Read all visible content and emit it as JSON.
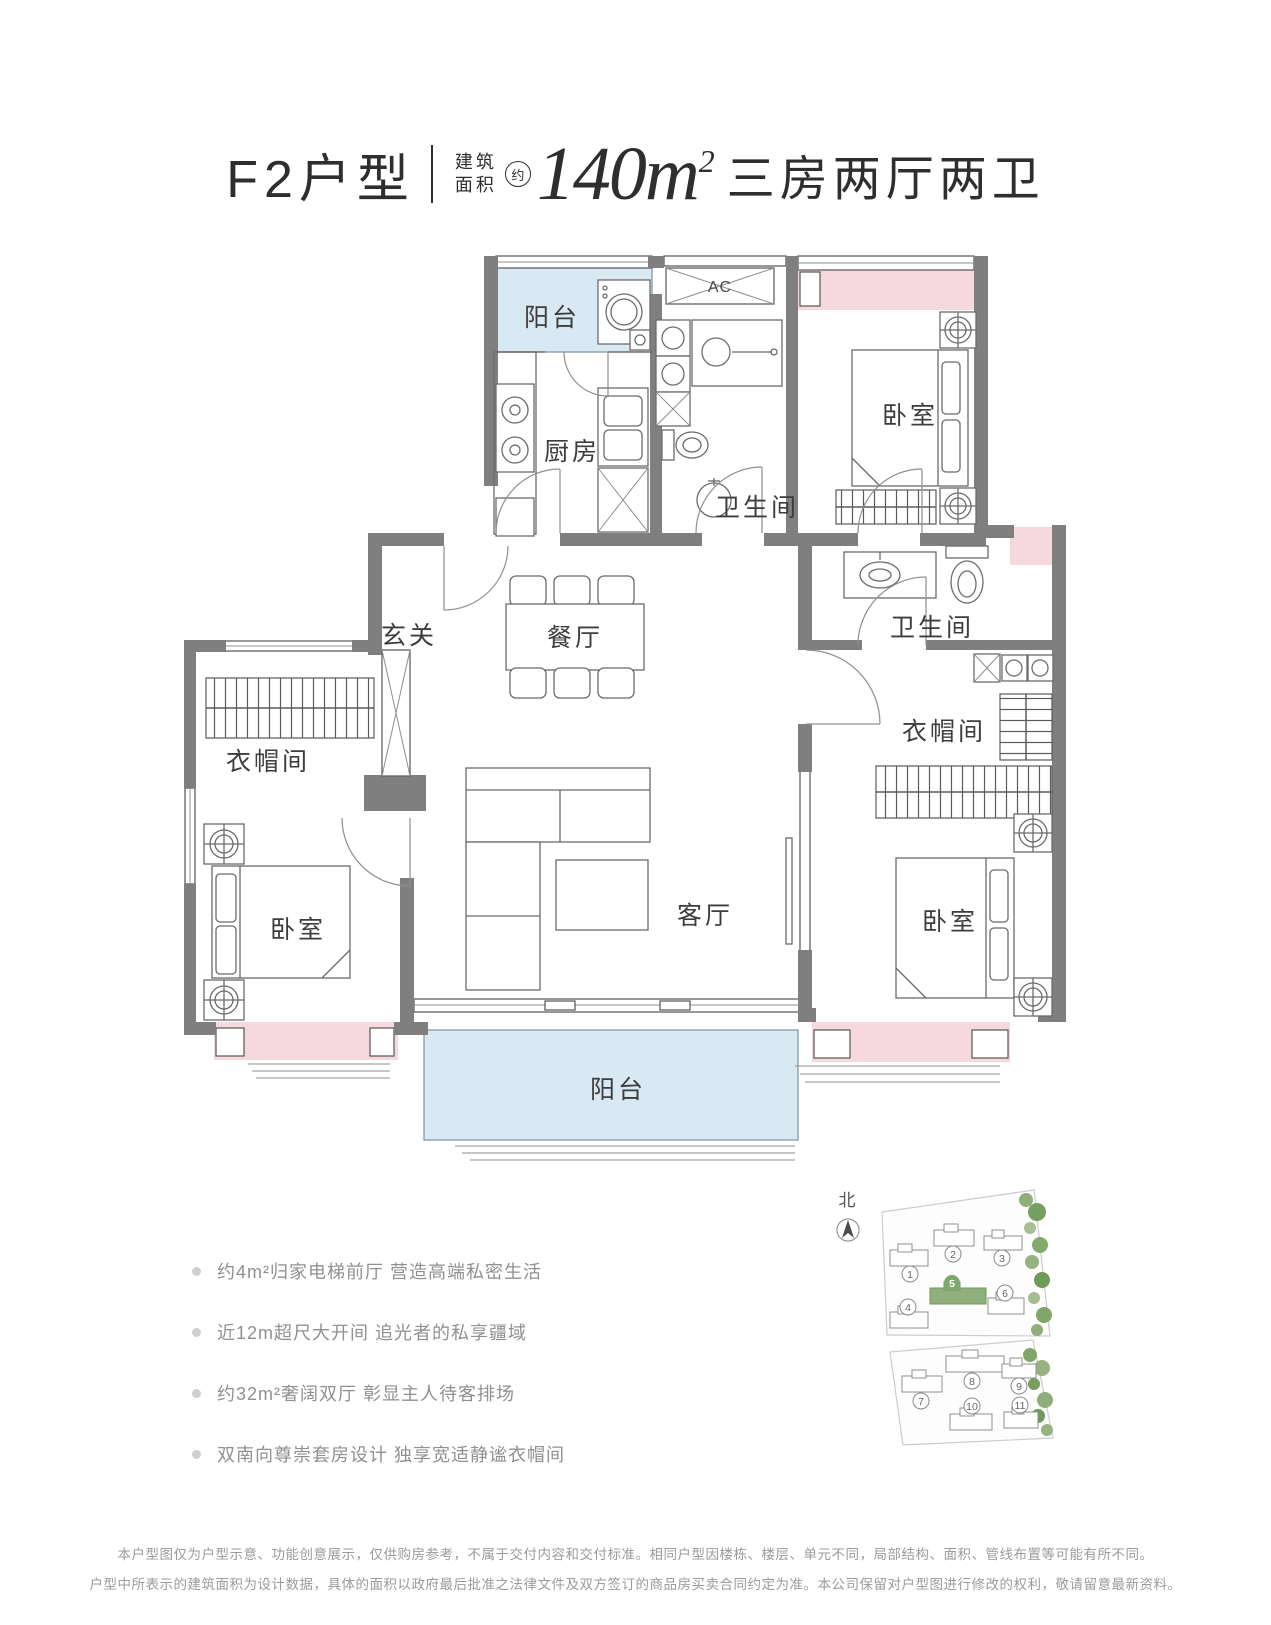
{
  "header": {
    "unit_name": "F2户型",
    "area_label_line1": "建筑",
    "area_label_line2": "面积",
    "approx_badge": "约",
    "area_value": "140m",
    "area_sup": "2",
    "layout_desc": "三房两厅两卫"
  },
  "floorplan": {
    "labels": {
      "balcony_top": "阳台",
      "kitchen": "厨房",
      "ac_unit": "AC",
      "bath_top": "卫生间",
      "bedroom_top": "卧室",
      "foyer": "玄关",
      "dining": "餐厅",
      "bath_right": "卫生间",
      "cloakroom_right": "衣帽间",
      "cloakroom_left": "衣帽间",
      "bedroom_left": "卧室",
      "living": "客厅",
      "bedroom_right": "卧室",
      "balcony_bottom": "阳台"
    },
    "colors": {
      "wall": "#7f7f7f",
      "balcony_fill": "#d9e9f3",
      "bay_window_fill": "#f6d9de",
      "highlight_green": "#7fa86b"
    }
  },
  "sitemap": {
    "north": "北",
    "highlighted_building": "5",
    "numbers": [
      "1",
      "2",
      "3",
      "4",
      "5",
      "6",
      "7",
      "8",
      "9",
      "10",
      "11"
    ]
  },
  "features": {
    "items": [
      "约4m²归家电梯前厅 营造高端私密生活",
      "近12m超尺大开间 追光者的私享疆域",
      "约32m²奢阔双厅 彰显主人待客排场",
      "双南向尊崇套房设计 独享宽适静谧衣帽间"
    ]
  },
  "disclaimer": {
    "line1": "本户型图仅为户型示意、功能创意展示，仅供购房参考，不属于交付内容和交付标准。相同户型因楼栋、楼层、单元不同，局部结构、面积、管线布置等可能有所不同。",
    "line2": "户型中所表示的建筑面积为设计数据，具体的面积以政府最后批准之法律文件及双方签订的商品房买卖合同约定为准。本公司保留对户型图进行修改的权利，敬请留意最新资料。"
  }
}
